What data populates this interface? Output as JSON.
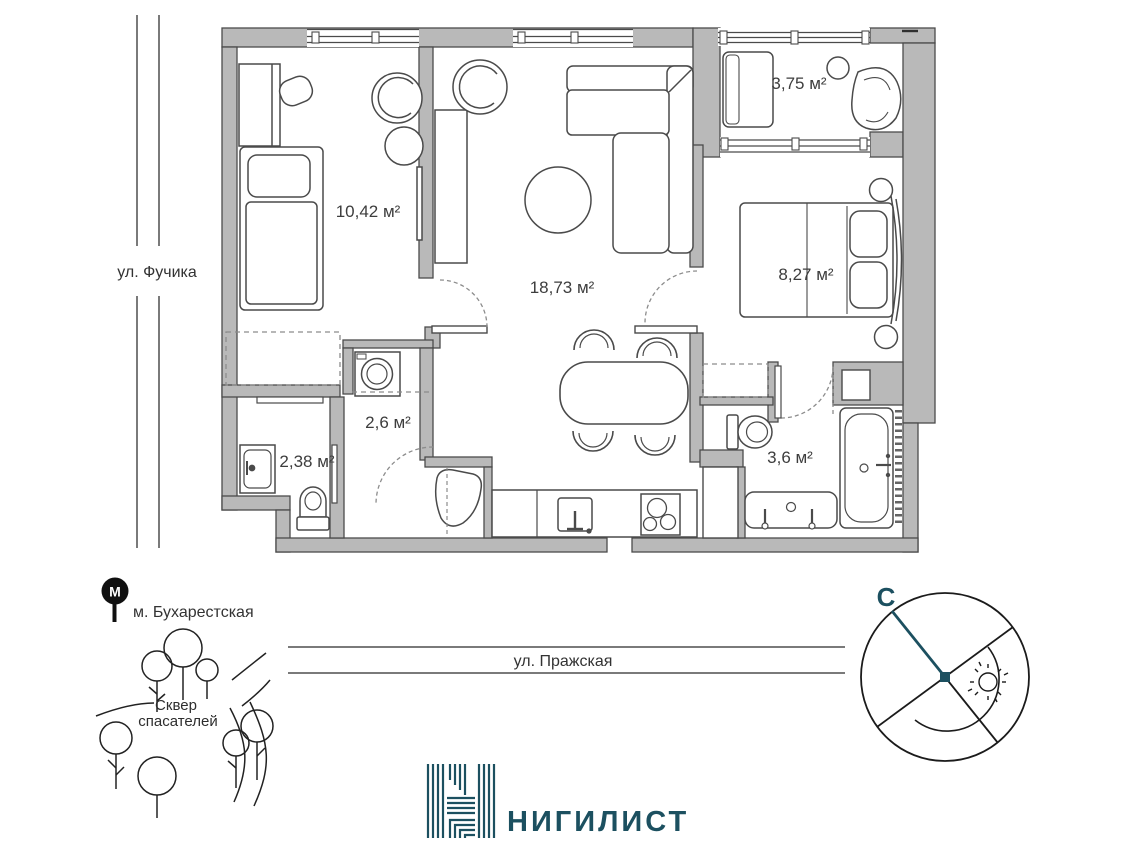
{
  "plan": {
    "rooms": [
      {
        "id": "room",
        "area_label": "10,42 м²"
      },
      {
        "id": "living",
        "area_label": "18,73 м²"
      },
      {
        "id": "balcony",
        "area_label": "3,75 м²"
      },
      {
        "id": "bedroom",
        "area_label": "8,27 м²"
      },
      {
        "id": "hallway",
        "area_label": "2,6 м²"
      },
      {
        "id": "wc-guest",
        "area_label": "2,38 м²"
      },
      {
        "id": "bathroom",
        "area_label": "3,6 м²"
      }
    ]
  },
  "surroundings": {
    "street_left": "ул. Фучика",
    "street_bottom": "ул. Пражская",
    "metro_label": "м. Бухарестская",
    "metro_letter": "М",
    "park_name_line1": "Сквер",
    "park_name_line2": "спасателей"
  },
  "compass": {
    "north_label": "С"
  },
  "brand": {
    "logo_text": "НИГИЛИСТ"
  },
  "colors": {
    "accent": "#1c5060",
    "wall_fill": "#b9b9b9",
    "outline": "#4a4a4a"
  }
}
